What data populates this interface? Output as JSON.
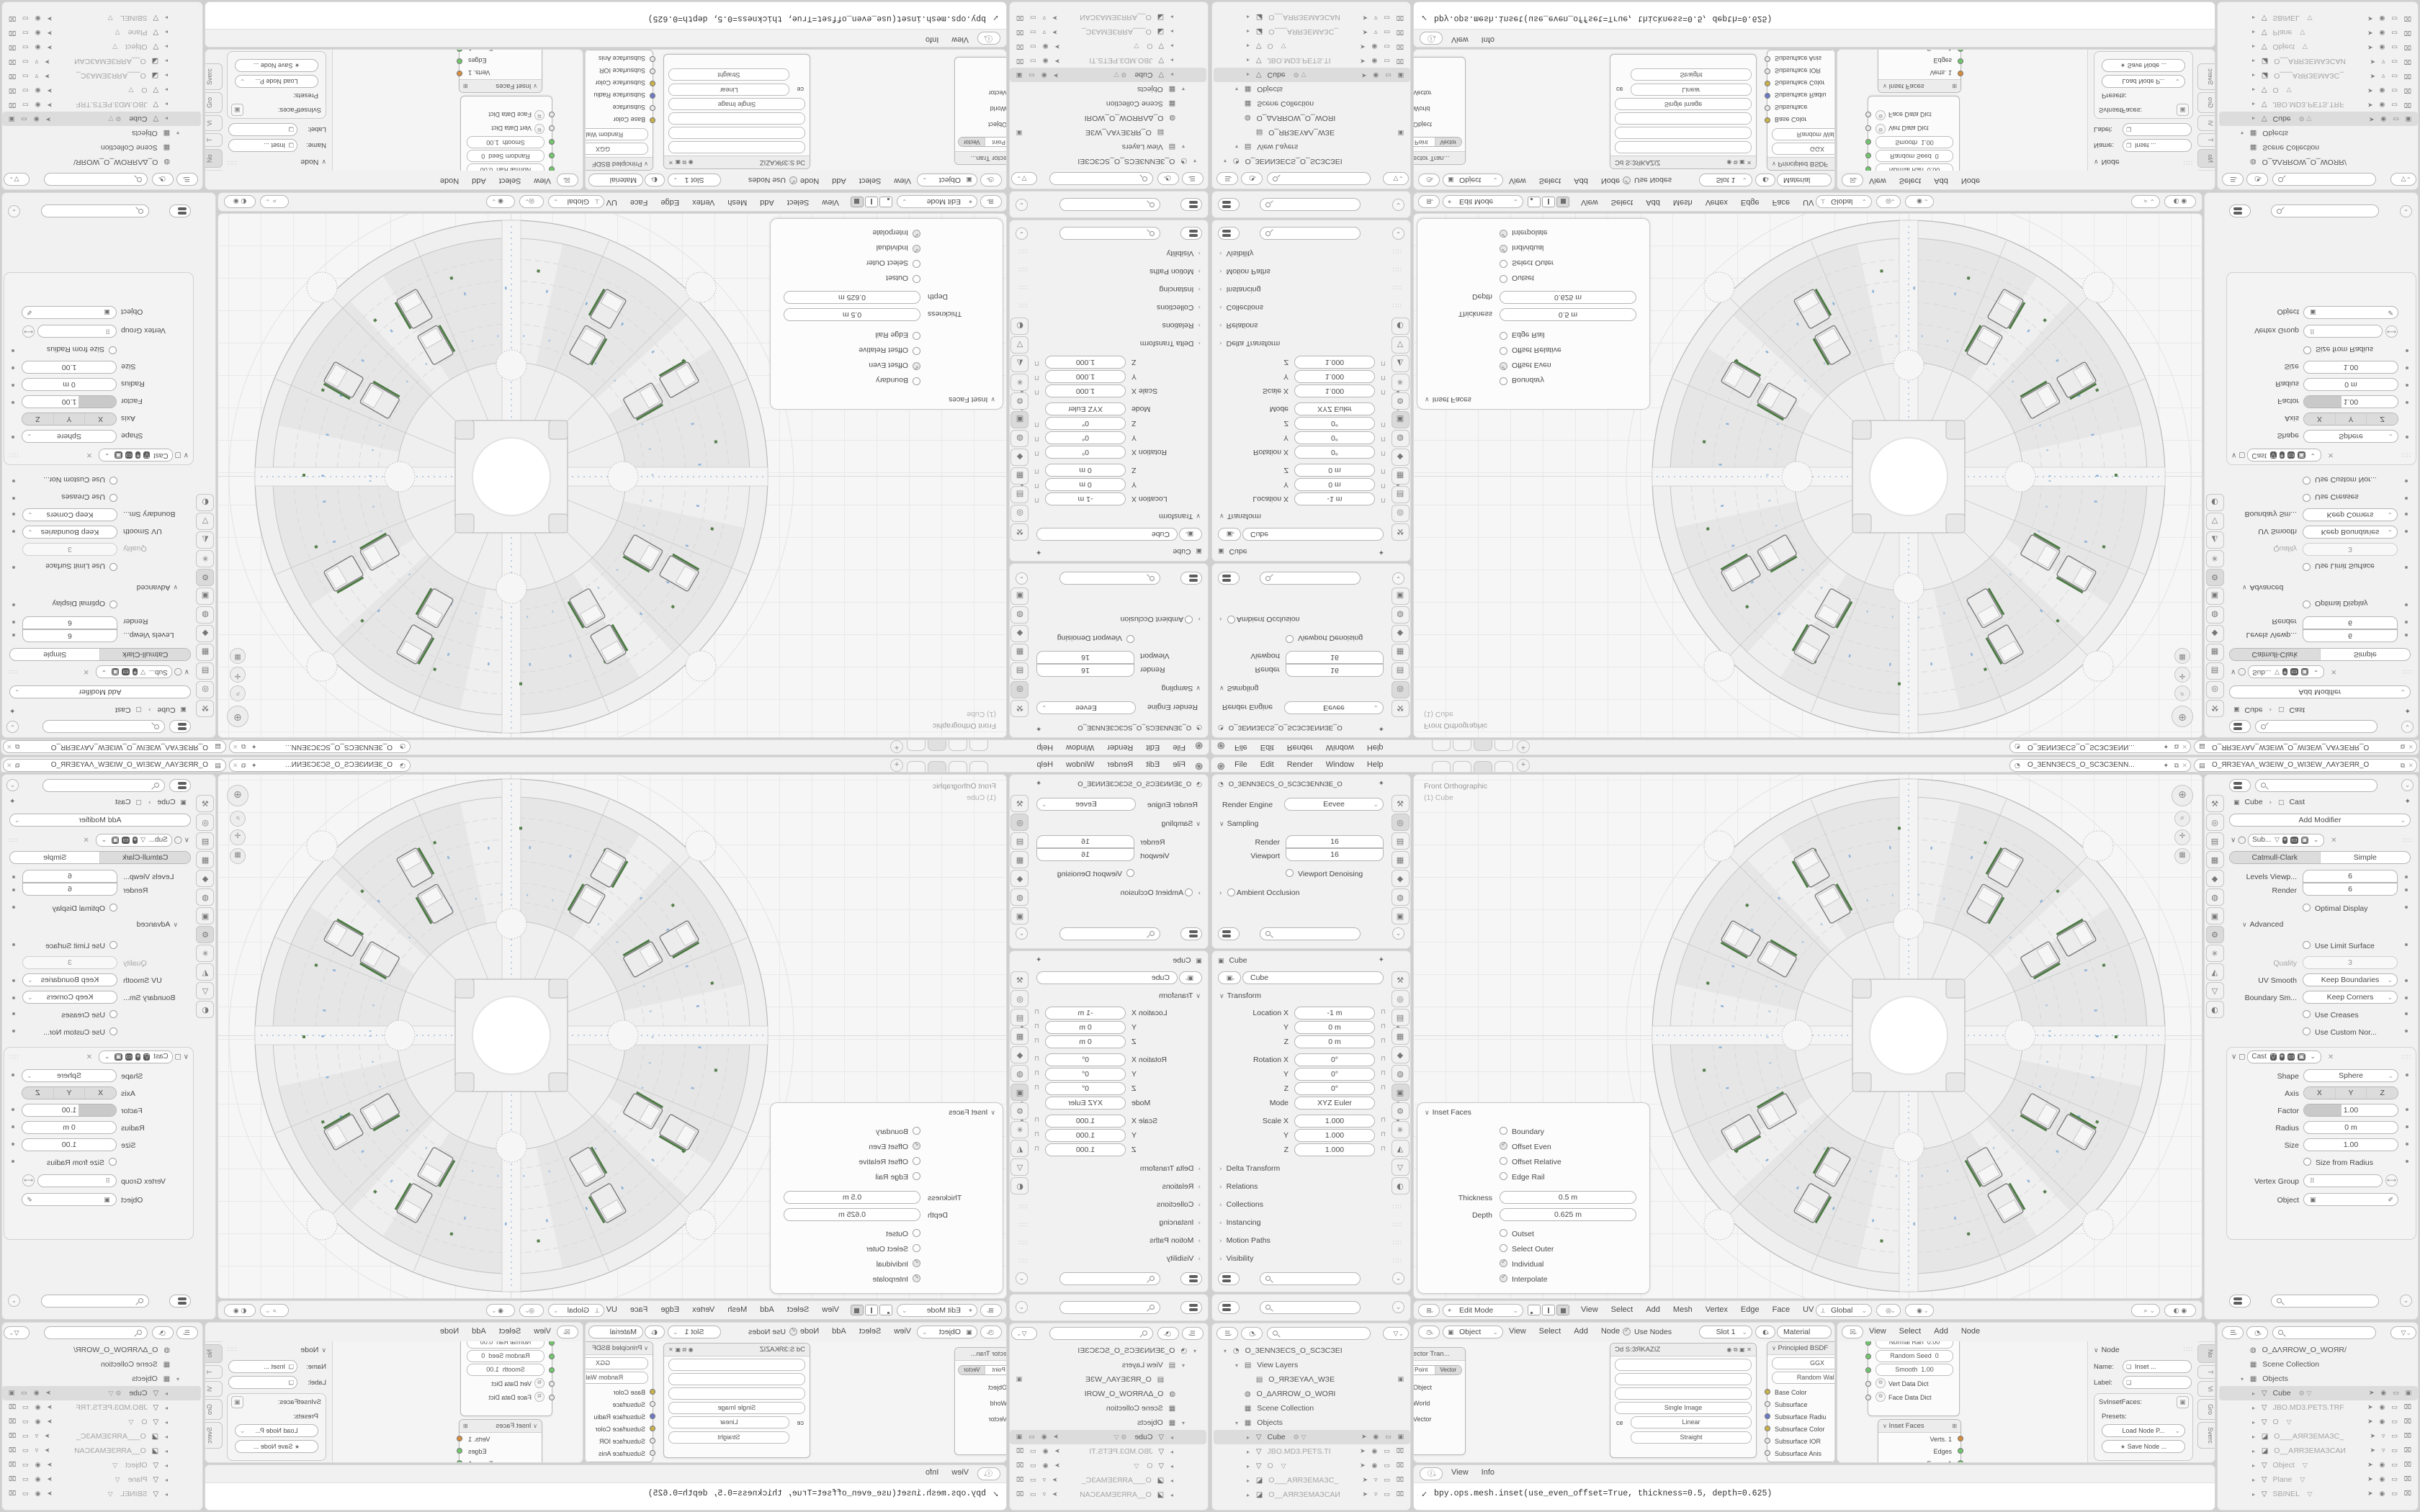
{
  "accent_colors": {
    "selection_bg": "#dcdcdc",
    "socket_green": "#71c56c",
    "socket_yellow": "#c9b24a",
    "socket_blue": "#6d7bc7",
    "socket_orange": "#d98c3c",
    "edge_green": "#4d7a45",
    "tick_blue": "#8fb3d9"
  },
  "icons": {
    "blender_logo": "֎",
    "pin": "✦",
    "copy": "⧉",
    "close": "✕",
    "chevron": "⌄",
    "caret_right": "›",
    "caret_down": "∨",
    "grip": "∷∷",
    "magnifier": "search-glass",
    "funnel": "▽",
    "list": "☰",
    "scene": "◔",
    "view_layer": "▤",
    "world": "◍",
    "collection": "▦",
    "mesh": "▽",
    "camera_obj": "◪",
    "object": "▣",
    "wrench": "⚙",
    "info": "ⓘ",
    "clock": "◷",
    "checker": "☒",
    "star": "★",
    "lock_open": "⊓",
    "axis_gizmo": "⊕",
    "zoom": "⌕",
    "move": "✛",
    "grid": "▦",
    "editmode": "⌖",
    "editor_chooser": "⊞",
    "orient": "⟂",
    "snap_target": "◎",
    "proportional": "◉"
  },
  "topbar": {
    "menus": [
      "File",
      "Edit",
      "Render",
      "Window",
      "Help"
    ],
    "workspace_tabs": [
      {
        "mod": ""
      },
      {
        "mod": ""
      },
      {
        "mod": "on"
      },
      {
        "mod": ""
      }
    ],
    "tab_add": "+",
    "scene_name": "O_ЗENNЗECS_O_SCЗCЗENN...",
    "view_layer_name": "O_ЯRЗEYAΛ_WЗEIW_O_WIЗEW_ΛAYЗEЯR_O"
  },
  "props_render": {
    "breadcrumb": "O_ЗENNЗECS_O_SCЗCЗENNЗE_O",
    "tabs": [
      {
        "g": "⚒",
        "mod": ""
      },
      {
        "g": "◎",
        "mod": "on"
      },
      {
        "g": "▤",
        "mod": ""
      },
      {
        "g": "▦",
        "mod": ""
      },
      {
        "g": "◆",
        "mod": ""
      },
      {
        "g": "◍",
        "mod": ""
      },
      {
        "g": "▣",
        "mod": ""
      }
    ],
    "engine_label": "Render Engine",
    "engine_value": "Eevee",
    "sampling": "Sampling",
    "render_label": "Render",
    "render_value": "16",
    "viewport_label": "Viewport",
    "viewport_value": "16",
    "denoise": "Viewport Denoising",
    "ao": "Ambient Occlusion"
  },
  "props_object": {
    "breadcrumb": "Cube",
    "name_value": "Cube",
    "transform": "Transform",
    "tabs": [
      {
        "g": "⚒",
        "mod": ""
      },
      {
        "g": "◎",
        "mod": ""
      },
      {
        "g": "▤",
        "mod": ""
      },
      {
        "g": "▦",
        "mod": ""
      },
      {
        "g": "◆",
        "mod": ""
      },
      {
        "g": "◍",
        "mod": ""
      },
      {
        "g": "▣",
        "mod": "on"
      },
      {
        "g": "⚙",
        "mod": ""
      },
      {
        "g": "✳",
        "mod": ""
      },
      {
        "g": "◭",
        "mod": ""
      },
      {
        "g": "▽",
        "mod": ""
      },
      {
        "g": "◐",
        "mod": ""
      }
    ],
    "rows": [
      {
        "l": "Location X",
        "v": "-1 m",
        "mod": ""
      },
      {
        "l": "Y",
        "v": "0 m",
        "mod": ""
      },
      {
        "l": "Z",
        "v": "0 m",
        "mod": ""
      },
      {
        "l": "Rotation X",
        "v": "0°",
        "mod": "gap"
      },
      {
        "l": "Y",
        "v": "0°",
        "mod": ""
      },
      {
        "l": "Z",
        "v": "0°",
        "mod": ""
      },
      {
        "l": "Mode",
        "v": "XYZ Euler",
        "mod": "dd"
      },
      {
        "l": "Scale X",
        "v": "1.000",
        "mod": "gap"
      },
      {
        "l": "Y",
        "v": "1.000",
        "mod": ""
      },
      {
        "l": "Z",
        "v": "1.000",
        "mod": ""
      }
    ],
    "collapsed": [
      "Delta Transform",
      "Relations",
      "Collections",
      "Instancing",
      "Motion Paths",
      "Visibility"
    ]
  },
  "props_mod": {
    "breadcrumb_obj": "Cube",
    "breadcrumb_mod": "Cast",
    "add_modifier": "Add Modifier",
    "tabs": [
      {
        "g": "⚒",
        "mod": ""
      },
      {
        "g": "◎",
        "mod": ""
      },
      {
        "g": "▤",
        "mod": ""
      },
      {
        "g": "▦",
        "mod": ""
      },
      {
        "g": "◆",
        "mod": ""
      },
      {
        "g": "◍",
        "mod": ""
      },
      {
        "g": "▣",
        "mod": ""
      },
      {
        "g": "⚙",
        "mod": "on"
      },
      {
        "g": "✳",
        "mod": ""
      },
      {
        "g": "◭",
        "mod": ""
      },
      {
        "g": "▽",
        "mod": ""
      },
      {
        "g": "◐",
        "mod": ""
      }
    ],
    "subdiv": {
      "name": "Sub...",
      "seg": [
        {
          "l": "Catmull-Clark",
          "mod": "on"
        },
        {
          "l": "Simple",
          "mod": ""
        }
      ],
      "rows": [
        {
          "l": "Levels Viewp...",
          "v": "6"
        },
        {
          "l": "Render",
          "v": "6"
        }
      ],
      "optimal": "Optimal Display",
      "advanced": "Advanced",
      "limit": "Use Limit Surface",
      "quality_l": "Quality",
      "quality_v": "3",
      "uv_l": "UV Smooth",
      "uv_v": "Keep Boundaries",
      "bs_l": "Boundary Sm...",
      "bs_v": "Keep Corners",
      "creases": "Use Creases",
      "custom": "Use Custom Nor..."
    },
    "cast": {
      "name": "Cast",
      "shape_l": "Shape",
      "shape_v": "Sphere",
      "axis_l": "Axis",
      "axis": [
        {
          "l": "X",
          "mod": "on"
        },
        {
          "l": "Y",
          "mod": "on"
        },
        {
          "l": "Z",
          "mod": "on"
        }
      ],
      "factor_l": "Factor",
      "factor_v": "1.00",
      "radius_l": "Radius",
      "radius_v": "0 m",
      "size_l": "Size",
      "size_v": "1.00",
      "sfr": "Size from Radius",
      "vg_l": "Vertex Group",
      "obj_l": "Object"
    }
  },
  "viewport": {
    "label1": "Front Orthographic",
    "label2": "(1) Cube",
    "inset": {
      "title": "Inset Faces",
      "checks1": [
        {
          "l": "Boundary",
          "c": false
        },
        {
          "l": "Offset Even",
          "c": true
        },
        {
          "l": "Offset Relative",
          "c": false
        },
        {
          "l": "Edge Rail",
          "c": false
        }
      ],
      "thickness_l": "Thickness",
      "thickness_v": "0.5 m",
      "depth_l": "Depth",
      "depth_v": "0.625 m",
      "checks2": [
        {
          "l": "Outset",
          "c": false
        },
        {
          "l": "Select Outer",
          "c": false
        },
        {
          "l": "Individual",
          "c": true
        },
        {
          "l": "Interpolate",
          "c": true
        }
      ]
    },
    "header": {
      "mode": "Edit Mode",
      "menus": [
        "View",
        "Select",
        "Add",
        "Mesh",
        "Vertex",
        "Edge",
        "Face",
        "UV"
      ],
      "orient": "Global"
    }
  },
  "shader": {
    "context": "Object",
    "menus": [
      "View",
      "Select",
      "Add",
      "Node"
    ],
    "use_nodes": "Use Nodes",
    "slot": "Slot 1",
    "material": "Material",
    "vt": {
      "title": "Vector Tran...",
      "seg": [
        {
          "l": "Point",
          "mod": ""
        },
        {
          "l": "Vector",
          "mod": "on"
        }
      ],
      "rows": [
        "Object",
        "World",
        "Vector"
      ]
    },
    "img": {
      "title": "Ɔd S:ЗЯKAZIZ",
      "rows_dd": [
        "",
        "",
        "",
        "Single Image"
      ],
      "space_l": "ce",
      "space_v": "Linear",
      "alpha_v": "Straight"
    },
    "bsdf": {
      "title": "Principled BSDF",
      "dd1": "GGX",
      "dd2": "Random Walk",
      "sockets": [
        {
          "l": "Base Color",
          "c": "y"
        },
        {
          "l": "Subsurface",
          "c": "w"
        },
        {
          "l": "Subsurface Radiu",
          "c": "b"
        },
        {
          "l": "Subsurface Color",
          "c": "y"
        },
        {
          "l": "Subsurface IOR",
          "c": "w"
        },
        {
          "l": "Subsurface Anis",
          "c": "w"
        }
      ]
    }
  },
  "sverchok": {
    "menus": [
      "View",
      "Select",
      "Add",
      "Node"
    ],
    "data_node": {
      "rows": [
        {
          "l": "Normal Ran",
          "v": "0.00"
        },
        {
          "l": "Random Seed",
          "v": "0"
        },
        {
          "l": "Smooth",
          "v": "1.00"
        }
      ],
      "dicts": [
        "Vert Data Dict",
        "Face Data Dict"
      ]
    },
    "inset_node": {
      "title": "Inset Faces",
      "outs": [
        {
          "l": "Verts. 1",
          "c": "o"
        },
        {
          "l": "Edges",
          "c": "g"
        },
        {
          "l": "Faces. 1",
          "c": "g"
        },
        {
          "l": "Face data",
          "c": "g"
        }
      ]
    },
    "npanel": {
      "title": "Node",
      "name_l": "Name:",
      "name_v": "Inset ...",
      "label_l": "Label:",
      "box_title": "SvInsetFaces:",
      "presets": "Presets:",
      "load": "Load Node P...",
      "save": "Save Node ...",
      "tabs": [
        {
          "l": "No",
          "mod": "on"
        },
        {
          "l": "T",
          "mod": ""
        },
        {
          "l": "Vi",
          "mod": ""
        },
        {
          "l": "Gro",
          "mod": ""
        },
        {
          "l": "Sverc",
          "mod": ""
        }
      ]
    }
  },
  "outliner_left": {
    "rows": [
      {
        "t": "▾",
        "g": "◔",
        "label": "O_ЗENNЗECS_O_SCЗCЗEI",
        "lv": "1",
        "mod": "",
        "x": "",
        "right": ""
      },
      {
        "t": "▾",
        "g": "▤",
        "label": "View Layers",
        "lv": "2",
        "mod": "",
        "x": "",
        "right": ""
      },
      {
        "t": "",
        "g": "▤",
        "label": "O_ЯRЗEYAΛ_WЗE",
        "lv": "3",
        "mod": "",
        "x": "",
        "right": "▣"
      },
      {
        "t": "",
        "g": "◍",
        "label": "O_ΔΛЯROW_O_WOЯI",
        "lv": "2",
        "mod": "",
        "x": "",
        "right": ""
      },
      {
        "t": "",
        "g": "▦",
        "label": "Scene Collection",
        "lv": "2",
        "mod": "",
        "x": "",
        "right": ""
      },
      {
        "t": "▾",
        "g": "▦",
        "label": "Objects",
        "lv": "2",
        "mod": "",
        "x": "",
        "right": ""
      },
      {
        "t": "▸",
        "g": "▽",
        "label": "Cube",
        "lv": "3",
        "mod": "sel",
        "x": "⚙ ▽",
        "right": "➤ ◉ ▭ ▣"
      },
      {
        "t": "▸",
        "g": "▽",
        "label": "JBO.MD3.PETS.TI",
        "lv": "3",
        "mod": "dim",
        "x": "",
        "right": "➤ ◉ ▭ ⌧"
      },
      {
        "t": "▸",
        "g": "▽",
        "label": "O",
        "lv": "3",
        "mod": "dim",
        "x": "▽",
        "right": "➤ ◉ ▭ ⌧"
      },
      {
        "t": "▸",
        "g": "◪",
        "label": "O___AЯRЗEMAЗC_",
        "lv": "3",
        "mod": "dim",
        "x": "",
        "right": "➤ ▿ ▭ ⌧"
      },
      {
        "t": "▸",
        "g": "◪",
        "label": "O__AЯRЗEMAЗCAИ",
        "lv": "3",
        "mod": "dim",
        "x": "",
        "right": "➤ ▿ ▭ ⌧"
      }
    ]
  },
  "outliner_right": {
    "rows": [
      {
        "t": "",
        "g": "◍",
        "label": "O_ΔΛЯROW_O_WOЯR/",
        "lv": "2",
        "mod": "",
        "x": "",
        "right": ""
      },
      {
        "t": "",
        "g": "▦",
        "label": "Scene Collection",
        "lv": "2",
        "mod": "",
        "x": "",
        "right": ""
      },
      {
        "t": "▾",
        "g": "▦",
        "label": "Objects",
        "lv": "2",
        "mod": "",
        "x": "",
        "right": ""
      },
      {
        "t": "▸",
        "g": "▽",
        "label": "Cube",
        "lv": "3",
        "mod": "sel",
        "x": "⚙ ▽",
        "right": "➤ ◉ ▭ ▣"
      },
      {
        "t": "▸",
        "g": "▽",
        "label": "JBO.MD3.PETS.TRF",
        "lv": "3",
        "mod": "dim",
        "x": "",
        "right": "➤ ◉ ▭ ⌧"
      },
      {
        "t": "▸",
        "g": "▽",
        "label": "O",
        "lv": "3",
        "mod": "dim",
        "x": "▽",
        "right": "➤ ◉ ▭ ⌧"
      },
      {
        "t": "▸",
        "g": "◪",
        "label": "O___AЯRЗEMAЗC_",
        "lv": "3",
        "mod": "dim",
        "x": "",
        "right": "➤ ▿ ▭ ⌧"
      },
      {
        "t": "▸",
        "g": "◪",
        "label": "O__AЯRЗEMAЗCAИ",
        "lv": "3",
        "mod": "dim",
        "x": "",
        "right": "➤ ▿ ▭ ⌧"
      },
      {
        "t": "▸",
        "g": "▽",
        "label": "Object",
        "lv": "3",
        "mod": "dim",
        "x": "▽",
        "right": "➤ ◉ ▭ ⌧"
      },
      {
        "t": "▸",
        "g": "▽",
        "label": "Plane",
        "lv": "3",
        "mod": "dim",
        "x": "▽",
        "right": "➤ ◉ ▭ ⌧"
      },
      {
        "t": "▸",
        "g": "▽",
        "label": "SBINEL",
        "lv": "3",
        "mod": "dim",
        "x": "▽",
        "right": "➤ ◉ ▭ ⌧"
      }
    ]
  },
  "info": {
    "menus": [
      "View",
      "Info"
    ],
    "line": "bpy.ops.mesh.inset(use_even_offset=True, thickness=0.5, depth=0.625)"
  }
}
